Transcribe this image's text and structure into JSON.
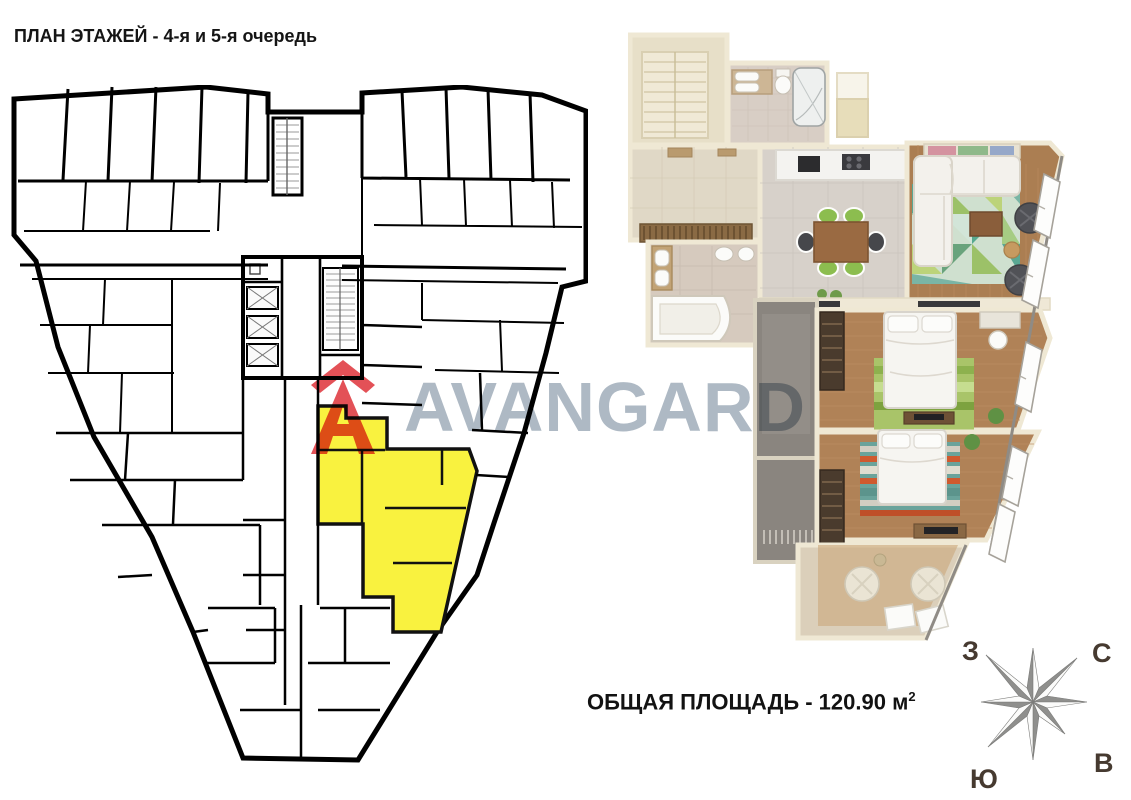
{
  "header": {
    "title": "ПЛАН ЭТАЖЕЙ - 4-я и 5-я очередь"
  },
  "watermark": {
    "text": "AVANGARD",
    "text_color": "#aeb9c4",
    "logo_color": "#e0393f"
  },
  "floor_plan": {
    "wall_color": "#000000",
    "highlight_color": "#f9f23f",
    "highlight_meaning": "selected apartment on floor plate"
  },
  "area": {
    "prefix": "ОБЩАЯ ПЛОЩАДЬ - 120.90 м",
    "sup": "2",
    "value_m2": "120.90"
  },
  "compass": {
    "west": "З",
    "north": "С",
    "east": "В",
    "south": "Ю"
  }
}
